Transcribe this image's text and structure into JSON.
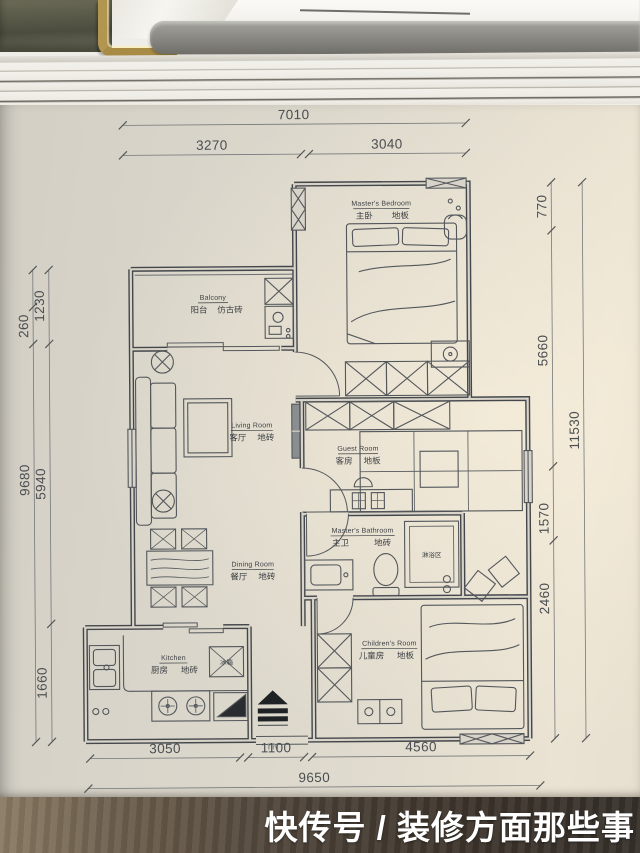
{
  "photo": {
    "watermark": "快传号 / 装修方面那些事"
  },
  "plan": {
    "rooms": {
      "master_bedroom": {
        "en": "Master's Bedroom",
        "zh": "主卧",
        "floor": "地板"
      },
      "balcony": {
        "en": "Balcony",
        "zh": "阳台",
        "floor": "仿古砖"
      },
      "living": {
        "en": "Living Room",
        "zh": "客厅",
        "floor": "地砖"
      },
      "guest": {
        "en": "Guest Room",
        "zh": "客房",
        "floor": "地板"
      },
      "master_bath": {
        "en": "Master's Bathroom",
        "zh": "主卫",
        "floor": "地砖"
      },
      "dining": {
        "en": "Dining Room",
        "zh": "餐厅",
        "floor": "地砖"
      },
      "kitchen": {
        "en": "Kitchen",
        "zh": "厨房",
        "floor": "地砖"
      },
      "children": {
        "en": "Children's Room",
        "zh": "儿童房",
        "floor": "地板"
      }
    },
    "labels": {
      "shower": "淋浴区",
      "fridge": "冰箱",
      "entrance": "IN"
    },
    "dims": {
      "top": {
        "total": "7010",
        "seg1": "3270",
        "seg2": "3040"
      },
      "bottom": {
        "seg1": "3050",
        "seg2": "1100",
        "seg3": "4560",
        "total": "9650"
      },
      "left": {
        "outer_small": "260",
        "outer_total": "9680",
        "inner1": "1230",
        "inner2": "5940",
        "inner3": "1660"
      },
      "right": {
        "inner1": "770",
        "inner2": "5660",
        "inner3": "1570",
        "inner4": "2460",
        "outer_total": "11530"
      }
    }
  }
}
